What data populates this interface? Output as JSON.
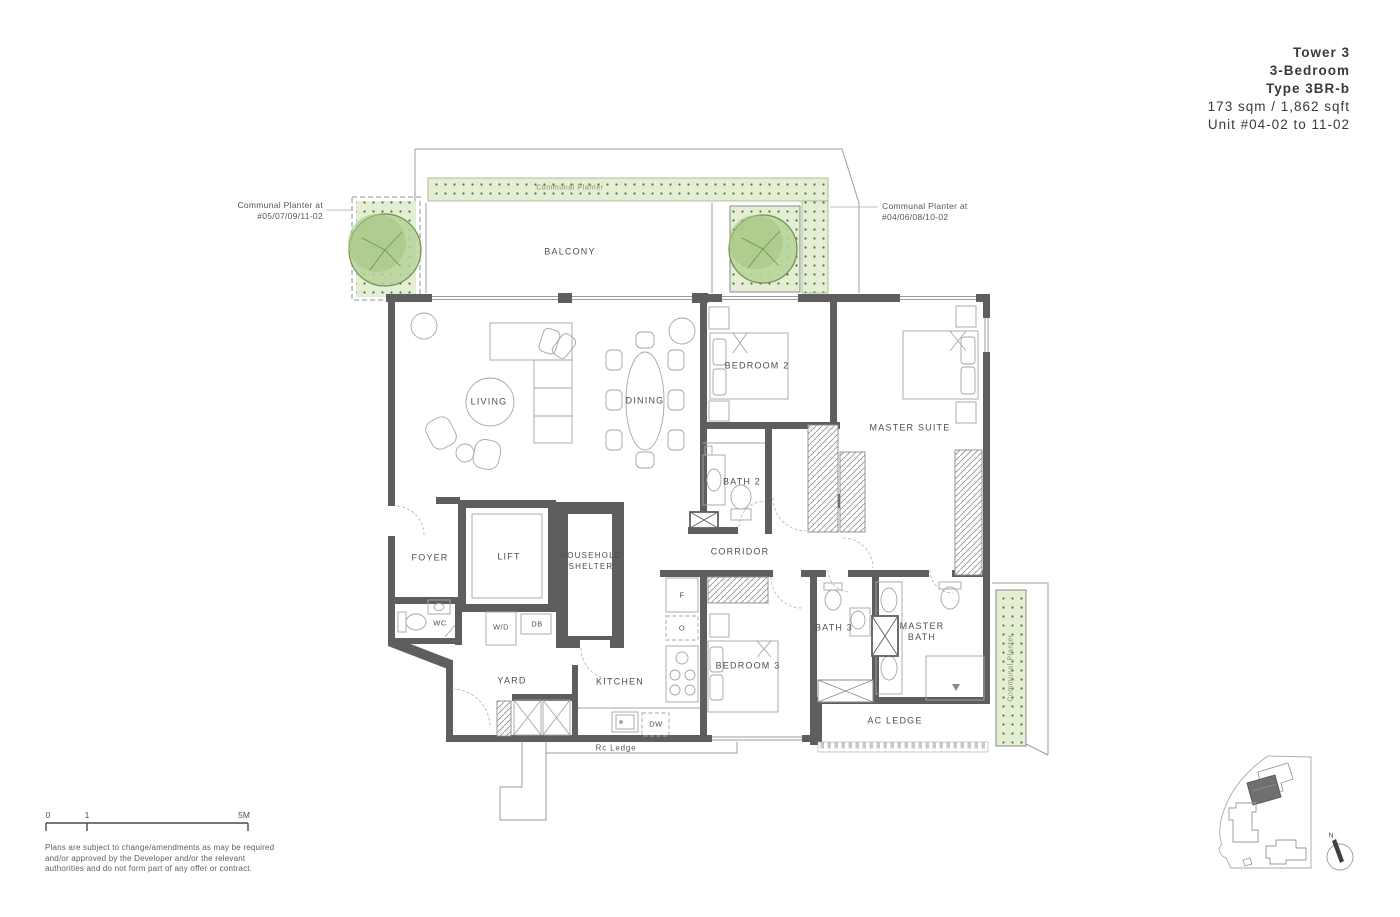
{
  "title_block": {
    "tower": "Tower 3",
    "bedroom_type": "3-Bedroom",
    "unit_type": "Type 3BR-b",
    "area": "173 sqm / 1,862 sqft",
    "units": "Unit #04-02 to 11-02"
  },
  "annotations": {
    "planter_left": "Communal Planter at\n#05/07/09/11-02",
    "planter_right": "Communal Planter at\n#04/06/08/10-02",
    "planter_top": "Communal Planter",
    "planter_side": "Communal Planter"
  },
  "rooms": {
    "balcony": "BALCONY",
    "living": "LIVING",
    "dining": "DINING",
    "bedroom2": "BEDROOM 2",
    "master_suite": "MASTER SUITE",
    "bath2": "BATH 2",
    "corridor": "CORRIDOR",
    "foyer": "FOYER",
    "lift": "LIFT",
    "household_shelter": "HOUSEHOLD\nSHELTER",
    "wc": "WC",
    "wd": "W/D",
    "db": "DB",
    "yard": "YARD",
    "kitchen": "KITCHEN",
    "fridge": "F",
    "oven": "O",
    "dishwasher": "DW",
    "bedroom3": "BEDROOM 3",
    "bath3": "BATH 3",
    "master_bath": "MASTER\nBATH",
    "ac_ledge": "AC LEDGE",
    "rc_ledge": "Rc Ledge"
  },
  "scale_bar": {
    "start": "0",
    "mid": "1",
    "end": "5M"
  },
  "key_plan": {
    "north": "N"
  },
  "disclaimer": "Plans are subject to change/amendments as may be required\nand/or approved by the Developer and/or the relevant\nauthorities and do not form part of any offer or contract.",
  "colors": {
    "wall": "#5e5e5e",
    "thin_line": "#9c9c9c",
    "planter_fill": "#e3eed3",
    "planter_dot": "#55713e",
    "tree_fill": "#b8d49a",
    "tree_line": "#6d9150",
    "label_text": "#4f4f4f"
  }
}
